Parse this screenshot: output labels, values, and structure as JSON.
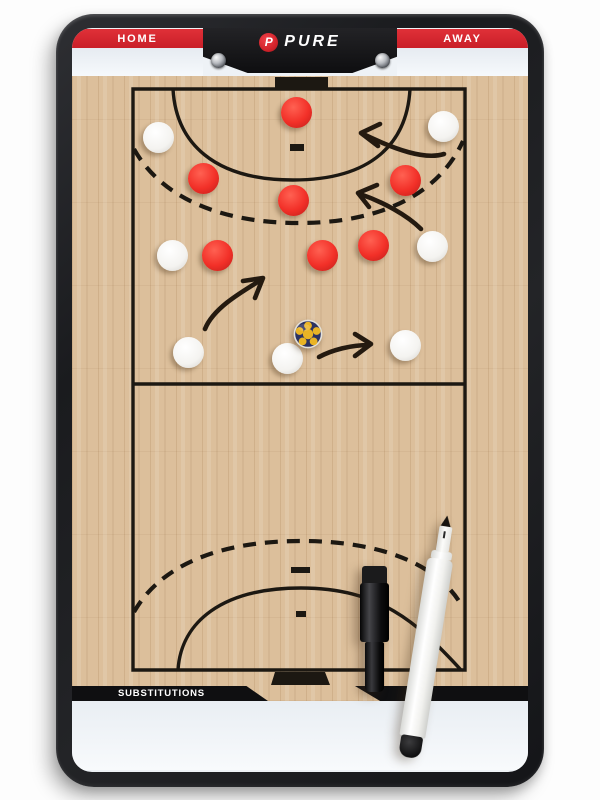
{
  "board": {
    "header": {
      "home_label": "HOME",
      "away_label": "AWAY",
      "brand": "PURE",
      "brand_initial": "P"
    },
    "footer": {
      "substitutions_label": "SUBSTITUTIONS"
    },
    "colors": {
      "frame": "#1b1c1f",
      "accent_red": "#d2232b",
      "header_black": "#111113",
      "wood": "#dcbf9b",
      "line": "#1c1812",
      "panel_white": "#eef2f6",
      "magnet_red": "#f23028",
      "magnet_white": "#f4f3f0",
      "ball_navy": "#2c3261",
      "ball_yellow": "#eab425"
    }
  },
  "court": {
    "arrow_color": "#241a10",
    "line_paths": [
      {
        "name": "boundary",
        "type": "stroke",
        "d": "M133,89 H465 V670 H133 Z"
      },
      {
        "name": "mid-line",
        "type": "stroke",
        "d": "M133,384 H465"
      },
      {
        "name": "top-6m-arc",
        "type": "stroke",
        "d": "M173,89 C176,143 214,180 293,180 C372,180 407,143 410,89"
      },
      {
        "name": "top-9m-arc",
        "type": "dashed",
        "d": "M134,149 C160,196 218,223 299,223 C381,223 439,194 463,141"
      },
      {
        "name": "bottom-6m-arc",
        "type": "stroke",
        "d": "M178,670 C181,622 222,588 301,588 C379,588 417,622 461,670"
      },
      {
        "name": "bottom-9m-arc",
        "type": "dashed",
        "d": "M134,612 C160,566 218,541 301,541 C384,541 441,566 463,608"
      },
      {
        "name": "top-4m-mark",
        "type": "fill",
        "d": "M290,144 h14 v7 h-14 Z"
      },
      {
        "name": "bottom-7m-mark",
        "type": "fill",
        "d": "M291,567 h19 v6 h-19 Z"
      },
      {
        "name": "bottom-4m-mark",
        "type": "fill",
        "d": "M296,611 h10 v6 h-10 Z"
      },
      {
        "name": "top-goal",
        "type": "fill",
        "d": "M275,77 h53 v12 h-53 Z"
      },
      {
        "name": "bottom-goal",
        "type": "fill",
        "d": "M275,672 h50 l5,13 h-59 Z"
      }
    ],
    "magnets": [
      {
        "color": "red",
        "x": 296,
        "y": 112
      },
      {
        "color": "red",
        "x": 203,
        "y": 178
      },
      {
        "color": "red",
        "x": 405,
        "y": 180
      },
      {
        "color": "red",
        "x": 293,
        "y": 200
      },
      {
        "color": "red",
        "x": 217,
        "y": 255
      },
      {
        "color": "red",
        "x": 322,
        "y": 255
      },
      {
        "color": "red",
        "x": 373,
        "y": 245
      },
      {
        "color": "white",
        "x": 158,
        "y": 137
      },
      {
        "color": "white",
        "x": 443,
        "y": 126
      },
      {
        "color": "white",
        "x": 172,
        "y": 255
      },
      {
        "color": "white",
        "x": 432,
        "y": 246
      },
      {
        "color": "white",
        "x": 188,
        "y": 352
      },
      {
        "color": "white",
        "x": 287,
        "y": 358
      },
      {
        "color": "white",
        "x": 405,
        "y": 345
      }
    ],
    "ball": {
      "x": 308,
      "y": 334
    },
    "arrows": [
      {
        "name": "arrow-top-right",
        "shaft": "M444,154 C425,160 396,150 363,134",
        "head": "M380,124 L361,133 L378,146"
      },
      {
        "name": "arrow-mid-right",
        "shaft": "M421,229 C407,215 383,202 360,194",
        "head": "M377,185 L358,193 L369,207"
      },
      {
        "name": "arrow-mid-left",
        "shaft": "M205,329 C213,309 238,294 261,280",
        "head": "M243,281 L263,278 L255,298"
      },
      {
        "name": "arrow-bottom",
        "shaft": "M319,357 C332,350 351,345 369,345",
        "head": "M355,334 L371,344 L355,356"
      }
    ]
  },
  "pens": {
    "black_marker": {
      "x": 360,
      "y": 566
    },
    "white_marker": {
      "x": 415,
      "y": 514,
      "angle_deg": 9
    }
  }
}
